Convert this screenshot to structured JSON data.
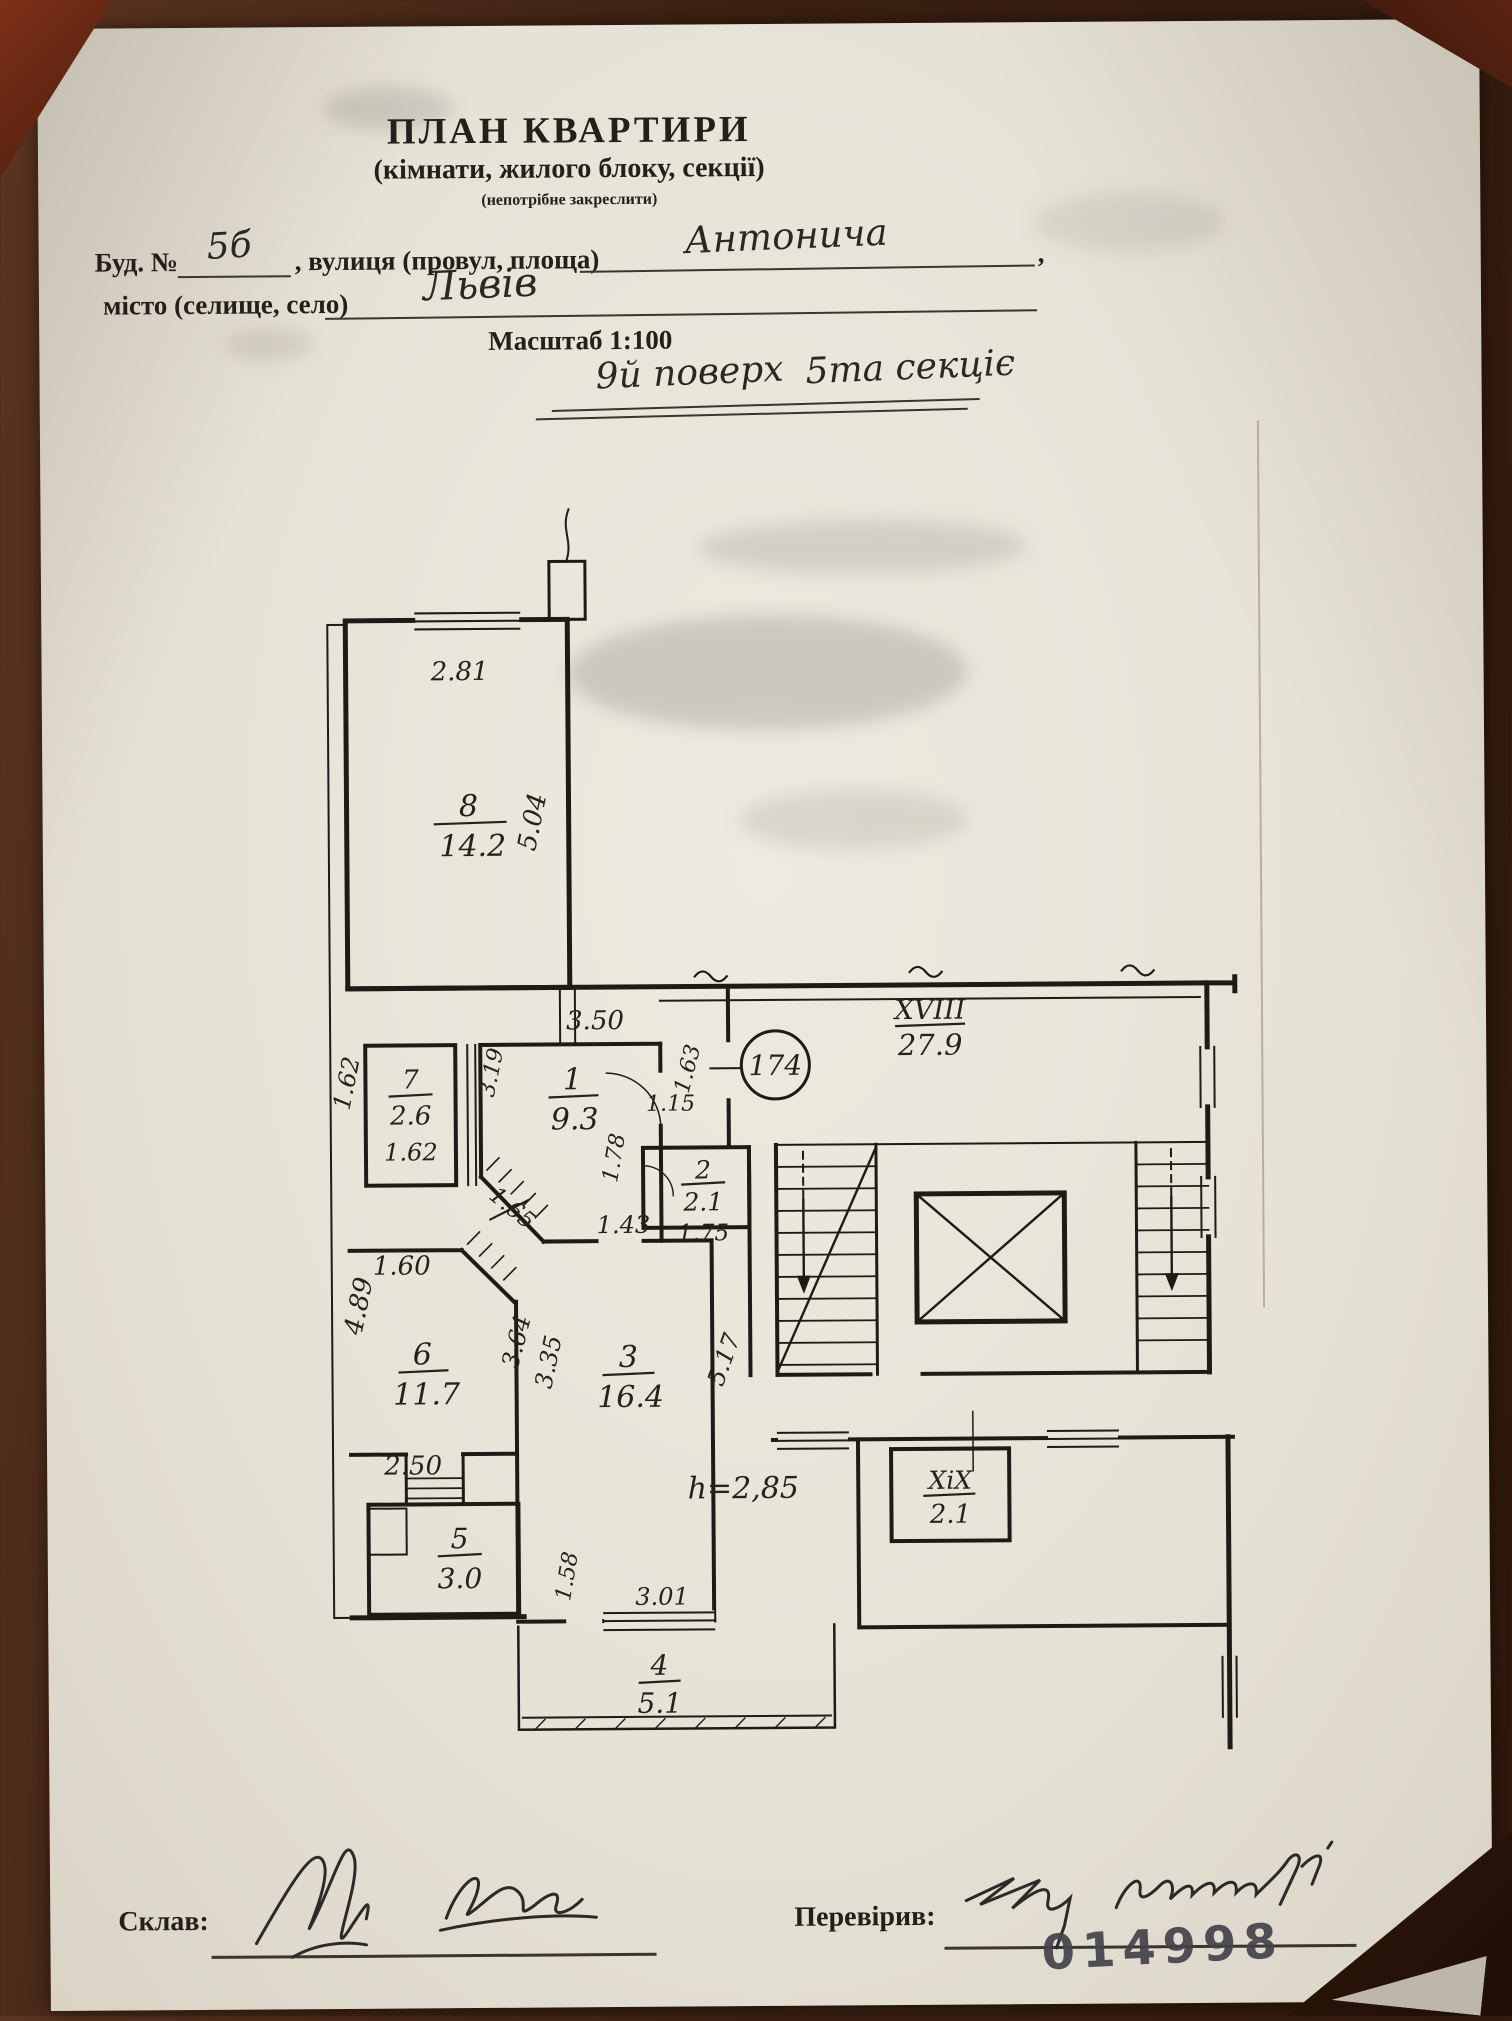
{
  "header": {
    "title": "ПЛАН КВАРТИРИ",
    "subtitle": "(кімнати, жилого блоку, секції)",
    "strike_note": "(непотрібне закреслити)",
    "bld_label": "Буд. №",
    "bld_value": "5б",
    "street_label": ", вулиця (провул, площа)",
    "street_value": "Антонича",
    "street_tail": ",",
    "city_label": "місто (селище, село)",
    "city_value": "Львів",
    "scale": "Масштаб 1:100",
    "floor_left": "9й поверх",
    "floor_right": "5та секціє"
  },
  "plan": {
    "circle_number": "174",
    "rooms": {
      "r8": {
        "num": "8",
        "area": "14.2"
      },
      "r7": {
        "num": "7",
        "area": "2.6"
      },
      "r1": {
        "num": "1",
        "area": "9.3"
      },
      "r2": {
        "num": "2",
        "area": "2.1"
      },
      "r3": {
        "num": "3",
        "area": "16.4"
      },
      "r4": {
        "num": "4",
        "area": "5.1"
      },
      "r5": {
        "num": "5",
        "area": "3.0"
      },
      "r6": {
        "num": "6",
        "area": "11.7"
      },
      "c18": {
        "num": "XVIII",
        "area": "27.9"
      },
      "c19": {
        "num": "XiX",
        "area": "2.1"
      }
    },
    "dims": {
      "d281": "2.81",
      "d504": "5.04",
      "d162L": "1.62",
      "d162B": "1.62",
      "d350": "3.50",
      "d319": "3.19",
      "d115": "1.15",
      "d163": "1.63",
      "d178": "1.78",
      "d143": "1.43",
      "d175": "1.75",
      "d160": "1.60",
      "d489": "4.89",
      "d364": "3.64",
      "d335": "3.35",
      "d165": "1.65",
      "d250": "2.50",
      "d517": "5.17",
      "h285": "h=2,85",
      "d158": "1.58",
      "d301": "3.01"
    }
  },
  "footer": {
    "made_label": "Склав:",
    "checked_label": "Перевірив:",
    "stamp": "014998"
  }
}
